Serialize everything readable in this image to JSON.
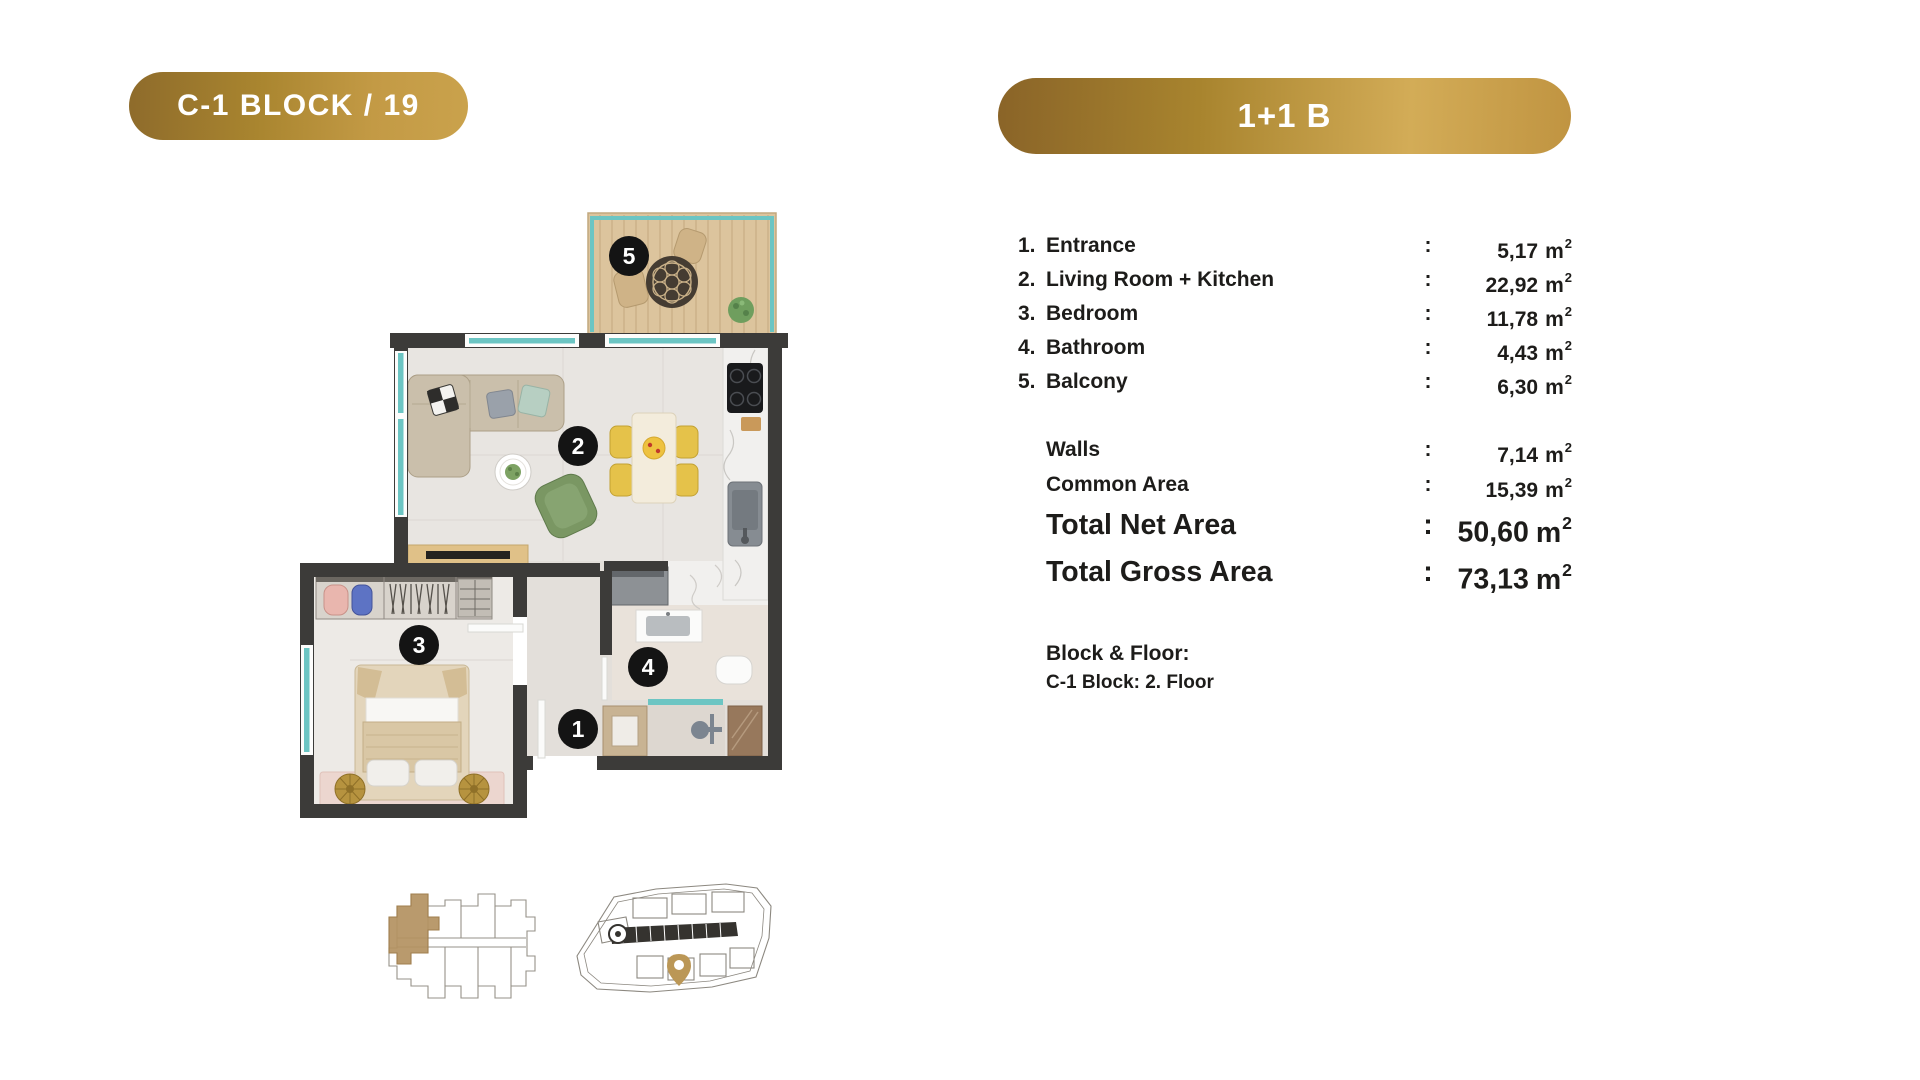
{
  "header": {
    "left_badge": "C-1 BLOCK / 19",
    "right_badge": "1+1 B"
  },
  "punct": {
    "colon": ":"
  },
  "units": {
    "base": "m",
    "sup": "2"
  },
  "rooms": [
    {
      "num": "1.",
      "label": "Entrance",
      "value": "5,17"
    },
    {
      "num": "2.",
      "label": "Living Room + Kitchen",
      "value": "22,92"
    },
    {
      "num": "3.",
      "label": "Bedroom",
      "value": "11,78"
    },
    {
      "num": "4.",
      "label": "Bathroom",
      "value": "4,43"
    },
    {
      "num": "5.",
      "label": "Balcony",
      "value": "6,30"
    }
  ],
  "extras": [
    {
      "label": "Walls",
      "value": "7,14"
    },
    {
      "label": "Common Area",
      "value": "15,39"
    }
  ],
  "totals": [
    {
      "label": "Total Net Area",
      "value": "50,60"
    },
    {
      "label": "Total Gross Area",
      "value": "73,13"
    }
  ],
  "block_floor": {
    "title": "Block & Floor:",
    "value": "C-1 Block: 2. Floor"
  },
  "plan": {
    "badges": [
      "1",
      "2",
      "3",
      "4",
      "5"
    ]
  },
  "colors": {
    "gold_dark": "#8a6428",
    "gold_light": "#d3ac57",
    "wall": "#3c3b39",
    "window_teal": "#6cc5c3",
    "balcony_wood": "#dcc49d",
    "pin_gold": "#bb9756",
    "key_unit_gold": "#b39161"
  }
}
